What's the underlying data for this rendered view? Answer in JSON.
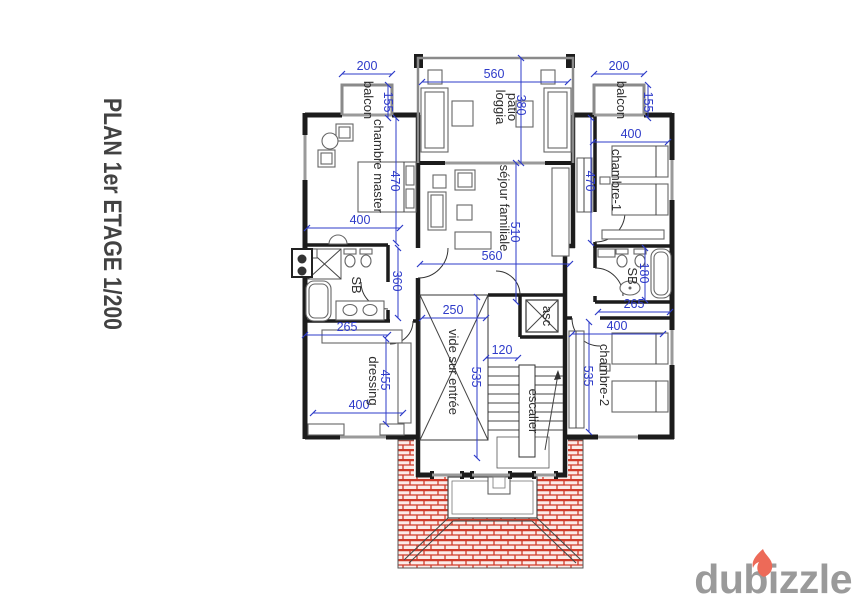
{
  "title": "PLAN 1er ETAGE 1/200",
  "watermark": {
    "brand": "dubizzle"
  },
  "colors": {
    "wall": "#1c1c1c",
    "dimension_blue": "#2e3bc9",
    "roof_hatch_red": "#cf3b2a",
    "furniture_gray": "#666666",
    "logo_gray": "#9a9a9a",
    "flame_red": "#ed6a58"
  },
  "rooms": {
    "balcon_left": "balcon",
    "balcon_right": "balcon",
    "chambre_master": "chambre master",
    "patio_line1": "patio",
    "patio_line2": "loggia",
    "sejour": "séjour familiale",
    "chambre_1": "chambre-1",
    "chambre_2": "chambre-2",
    "sb_left": "SB",
    "sb_right": "SB",
    "dressing": "dressing",
    "vide": "vide sur entrée",
    "escalier": "escalier",
    "ascenseur": "asc"
  },
  "dimensions": {
    "balcon_left_width": "200",
    "balcon_left_depth": "155",
    "balcon_right_width": "200",
    "balcon_right_depth": "155",
    "patio_width": "560",
    "patio_depth": "380",
    "master_width": "400",
    "master_height": "470",
    "sejour_width": "560",
    "sejour_height": "510",
    "hall_height": "360",
    "sb_left_width": "265",
    "dressing_width": "400",
    "dressing_height": "455",
    "vide_width": "250",
    "vide_height": "535",
    "stair_passage": "120",
    "chambre1_width": "400",
    "chambre1_height": "470",
    "sb_right_width": "265",
    "sb_right_depth": "180",
    "chambre2_width": "400",
    "chambre2_height": "535"
  }
}
